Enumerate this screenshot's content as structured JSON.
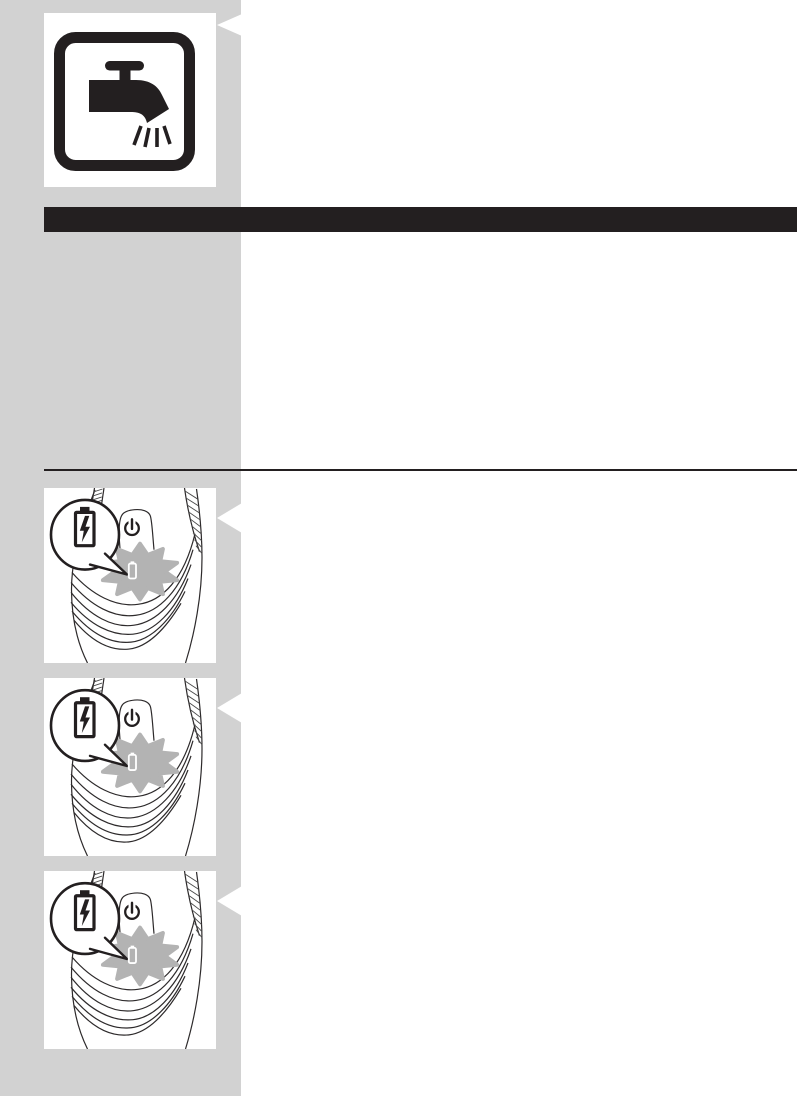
{
  "page": {
    "type": "user-manual-figure-page",
    "background": "#ffffff"
  },
  "colors": {
    "sidebar": "#d2d2d2",
    "ink": "#231f20",
    "star": "#b3b3b3",
    "lineart": "#2d2a2b",
    "figbg": "#ffffff"
  },
  "heading_bar": {
    "label": ""
  },
  "figures": {
    "washable": {
      "icon": "tap-running-water-icon"
    },
    "charging_steps": [
      {
        "icon": "shaver-illustration",
        "bubble_icon": "battery-charging-icon",
        "power_icon": "power-symbol-icon",
        "indicator_icon": "charge-indicator-light",
        "burst_icon": "blinking-star"
      },
      {
        "icon": "shaver-illustration",
        "bubble_icon": "battery-charging-icon",
        "power_icon": "power-symbol-icon",
        "indicator_icon": "charge-indicator-light",
        "burst_icon": "blinking-star"
      },
      {
        "icon": "shaver-illustration",
        "bubble_icon": "battery-charging-icon",
        "power_icon": "power-symbol-icon",
        "indicator_icon": "charge-indicator-light",
        "burst_icon": "blinking-star"
      }
    ],
    "callout_arrow_icon": "left-pointing-callout-arrow"
  }
}
